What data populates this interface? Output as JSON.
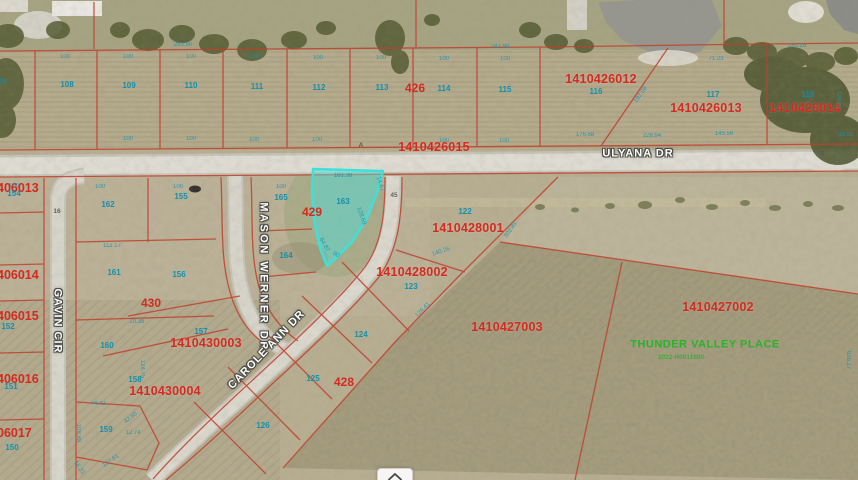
{
  "map": {
    "colors": {
      "parcel_id_red": "#d42a1f",
      "parcel_line_red": "#c0402c",
      "lot_number_cyan": "#0b8fae",
      "highlight_cyan": "#3ce1da",
      "subdivision_green": "#25b42a"
    },
    "selected_lot": "163",
    "labels": {
      "parcel_ids": [
        {
          "t": "1410426012",
          "x": 601,
          "y": 79
        },
        {
          "t": "1410426013",
          "x": 706,
          "y": 108
        },
        {
          "t": "1410426014",
          "x": 805,
          "y": 108
        },
        {
          "t": "1410426015",
          "x": 434,
          "y": 147
        },
        {
          "t": "1410428001",
          "x": 468,
          "y": 228
        },
        {
          "t": "1410428002",
          "x": 412,
          "y": 272
        },
        {
          "t": "1410427003",
          "x": 507,
          "y": 327
        },
        {
          "t": "1410427002",
          "x": 718,
          "y": 307
        },
        {
          "t": "1410430003",
          "x": 206,
          "y": 343
        },
        {
          "t": "1410430004",
          "x": 165,
          "y": 391
        }
      ],
      "block_numbers": [
        {
          "t": "426",
          "x": 415,
          "y": 88
        },
        {
          "t": "429",
          "x": 312,
          "y": 212
        },
        {
          "t": "430",
          "x": 151,
          "y": 303
        },
        {
          "t": "428",
          "x": 344,
          "y": 382
        }
      ],
      "edge_parcel_ids": [
        {
          "t": "406013",
          "y": 188
        },
        {
          "t": "406014",
          "y": 275
        },
        {
          "t": "406015",
          "y": 316
        },
        {
          "t": "406016",
          "y": 379
        },
        {
          "t": "06017",
          "y": 433
        }
      ],
      "lot_numbers": [
        {
          "t": "105",
          "x": 0,
          "y": 82
        },
        {
          "t": "108",
          "x": 67,
          "y": 85
        },
        {
          "t": "109",
          "x": 129,
          "y": 86
        },
        {
          "t": "110",
          "x": 191,
          "y": 86
        },
        {
          "t": "111",
          "x": 257,
          "y": 87
        },
        {
          "t": "112",
          "x": 319,
          "y": 88
        },
        {
          "t": "113",
          "x": 382,
          "y": 88
        },
        {
          "t": "114",
          "x": 444,
          "y": 89
        },
        {
          "t": "115",
          "x": 505,
          "y": 90
        },
        {
          "t": "116",
          "x": 596,
          "y": 92
        },
        {
          "t": "117",
          "x": 713,
          "y": 95
        },
        {
          "t": "118",
          "x": 808,
          "y": 95
        },
        {
          "t": "154",
          "x": 14,
          "y": 194
        },
        {
          "t": "162",
          "x": 108,
          "y": 205
        },
        {
          "t": "155",
          "x": 181,
          "y": 197
        },
        {
          "t": "165",
          "x": 281,
          "y": 198
        },
        {
          "t": "163",
          "x": 343,
          "y": 202
        },
        {
          "t": "164",
          "x": 286,
          "y": 256
        },
        {
          "t": "161",
          "x": 114,
          "y": 273
        },
        {
          "t": "156",
          "x": 179,
          "y": 275
        },
        {
          "t": "152",
          "x": 8,
          "y": 327
        },
        {
          "t": "160",
          "x": 107,
          "y": 346
        },
        {
          "t": "157",
          "x": 201,
          "y": 332
        },
        {
          "t": "158",
          "x": 135,
          "y": 380
        },
        {
          "t": "151",
          "x": 11,
          "y": 387
        },
        {
          "t": "159",
          "x": 106,
          "y": 430
        },
        {
          "t": "150",
          "x": 12,
          "y": 448
        },
        {
          "t": "122",
          "x": 465,
          "y": 212
        },
        {
          "t": "123",
          "x": 411,
          "y": 287
        },
        {
          "t": "124",
          "x": 361,
          "y": 335
        },
        {
          "t": "125",
          "x": 313,
          "y": 379
        },
        {
          "t": "126",
          "x": 263,
          "y": 426
        }
      ],
      "measurements": [
        {
          "t": "283.90",
          "x": 183,
          "y": 45
        },
        {
          "t": "241.90",
          "x": 500,
          "y": 47
        },
        {
          "t": "180.28",
          "x": 797,
          "y": 46
        },
        {
          "t": "71.23",
          "x": 716,
          "y": 59
        },
        {
          "t": "100",
          "x": 65,
          "y": 57
        },
        {
          "t": "100",
          "x": 128,
          "y": 57
        },
        {
          "t": "100",
          "x": 191,
          "y": 57
        },
        {
          "t": "100",
          "x": 254,
          "y": 57
        },
        {
          "t": "100",
          "x": 318,
          "y": 58
        },
        {
          "t": "100",
          "x": 381,
          "y": 58
        },
        {
          "t": "100",
          "x": 444,
          "y": 59
        },
        {
          "t": "100",
          "x": 505,
          "y": 59
        },
        {
          "t": "100",
          "x": 128,
          "y": 139
        },
        {
          "t": "100",
          "x": 191,
          "y": 139
        },
        {
          "t": "100",
          "x": 254,
          "y": 140
        },
        {
          "t": "100",
          "x": 317,
          "y": 140
        },
        {
          "t": "100",
          "x": 444,
          "y": 141
        },
        {
          "t": "100",
          "x": 504,
          "y": 141
        },
        {
          "t": "192.08",
          "x": 641,
          "y": 95,
          "r": -55
        },
        {
          "t": "176.58",
          "x": 585,
          "y": 135
        },
        {
          "t": "228.94",
          "x": 652,
          "y": 136
        },
        {
          "t": "145.56",
          "x": 724,
          "y": 134
        },
        {
          "t": "124.81",
          "x": 838,
          "y": 100,
          "r": 90
        },
        {
          "t": "16.81",
          "x": 846,
          "y": 135
        },
        {
          "t": "100",
          "x": 14,
          "y": 186
        },
        {
          "t": "100",
          "x": 100,
          "y": 187
        },
        {
          "t": "100",
          "x": 178,
          "y": 187
        },
        {
          "t": "100",
          "x": 281,
          "y": 187
        },
        {
          "t": "161.38",
          "x": 343,
          "y": 176
        },
        {
          "t": "14.67",
          "x": 380,
          "y": 184,
          "r": 72
        },
        {
          "t": "128.69",
          "x": 361,
          "y": 216,
          "r": 72
        },
        {
          "t": "64.87",
          "x": 324,
          "y": 245,
          "r": 60
        },
        {
          "t": "80",
          "x": 336,
          "y": 255,
          "r": 30
        },
        {
          "t": "112.17",
          "x": 112,
          "y": 246
        },
        {
          "t": "20.38",
          "x": 137,
          "y": 322
        },
        {
          "t": "124.75",
          "x": 142,
          "y": 369,
          "r": 90
        },
        {
          "t": "140.26",
          "x": 441,
          "y": 252,
          "r": -18
        },
        {
          "t": "302.81",
          "x": 511,
          "y": 230,
          "r": -55
        },
        {
          "t": "74.42",
          "x": 98,
          "y": 404
        },
        {
          "t": "42.65",
          "x": 131,
          "y": 418,
          "r": -40
        },
        {
          "t": "12.74",
          "x": 133,
          "y": 433
        },
        {
          "t": "108.88",
          "x": 78,
          "y": 433,
          "r": 90
        },
        {
          "t": "127.61",
          "x": 111,
          "y": 461,
          "r": -35
        },
        {
          "t": "16.31",
          "x": 79,
          "y": 468,
          "r": 55
        },
        {
          "t": "126.41",
          "x": 423,
          "y": 310,
          "r": -45
        },
        {
          "t": "626.17",
          "x": 848,
          "y": 360,
          "r": 90
        }
      ],
      "streets": [
        {
          "t": "ULYANA DR",
          "x": 638,
          "y": 154,
          "r": 0
        },
        {
          "t": "GAVIN CIR",
          "x": 57,
          "y": 321,
          "r": 90
        },
        {
          "t": "MASON WERNER DR",
          "x": 263,
          "y": 277,
          "r": 90,
          "wide": true
        },
        {
          "t": "CAROLE ANN DR",
          "x": 267,
          "y": 350,
          "r": -46
        }
      ],
      "road_markers": [
        {
          "t": "16",
          "x": 57,
          "y": 212
        },
        {
          "t": "45",
          "x": 394,
          "y": 196
        },
        {
          "t": "A",
          "x": 361,
          "y": 146
        },
        {
          "t": "2",
          "x": 822,
          "y": 154
        }
      ],
      "annotations": [
        {
          "t": "THUNDER VALLEY PLACE",
          "x": 705,
          "y": 345,
          "small": false
        },
        {
          "t": "2022-R0011880",
          "x": 681,
          "y": 358,
          "small": true
        }
      ]
    }
  },
  "controls": {
    "collapse_button": "chevron-up"
  }
}
